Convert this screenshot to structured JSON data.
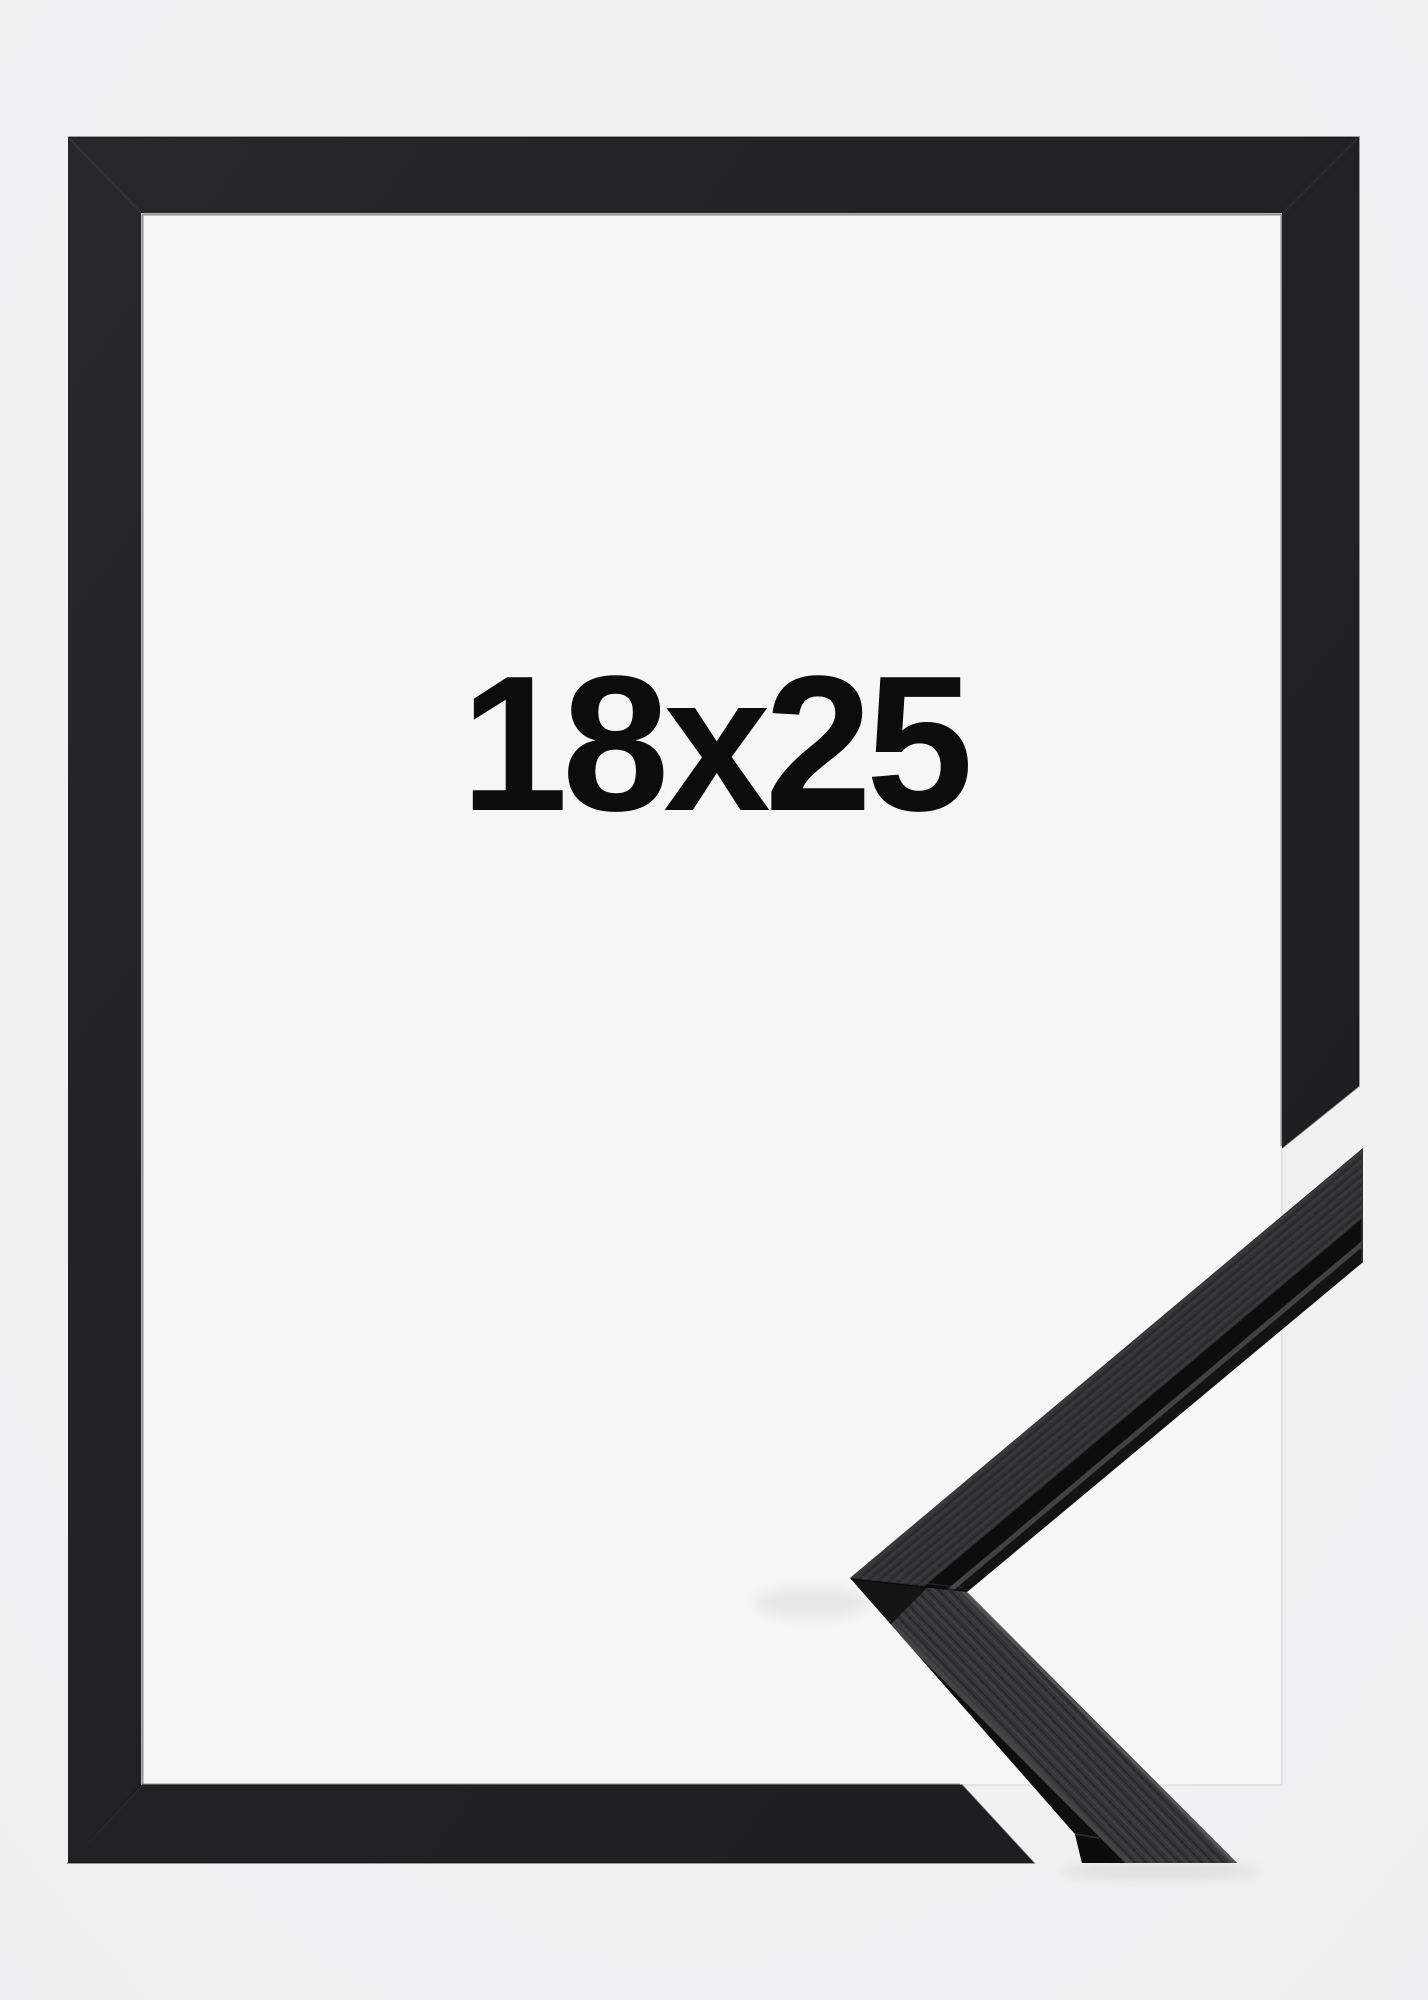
{
  "meta": {
    "alt": "Black wooden picture frame product photo, size 18x25, with corner moulding profile sample at lower right"
  },
  "frame": {
    "size_label": "18x25"
  },
  "colors": {
    "background": "#f1f1f2",
    "opening": "#f6f6f7",
    "frame_black": "#212123",
    "sample_face_upper": "#323234",
    "sample_face_lower": "#353537",
    "sample_dark": "#0e0e0f",
    "text": "#0c0c0c"
  }
}
